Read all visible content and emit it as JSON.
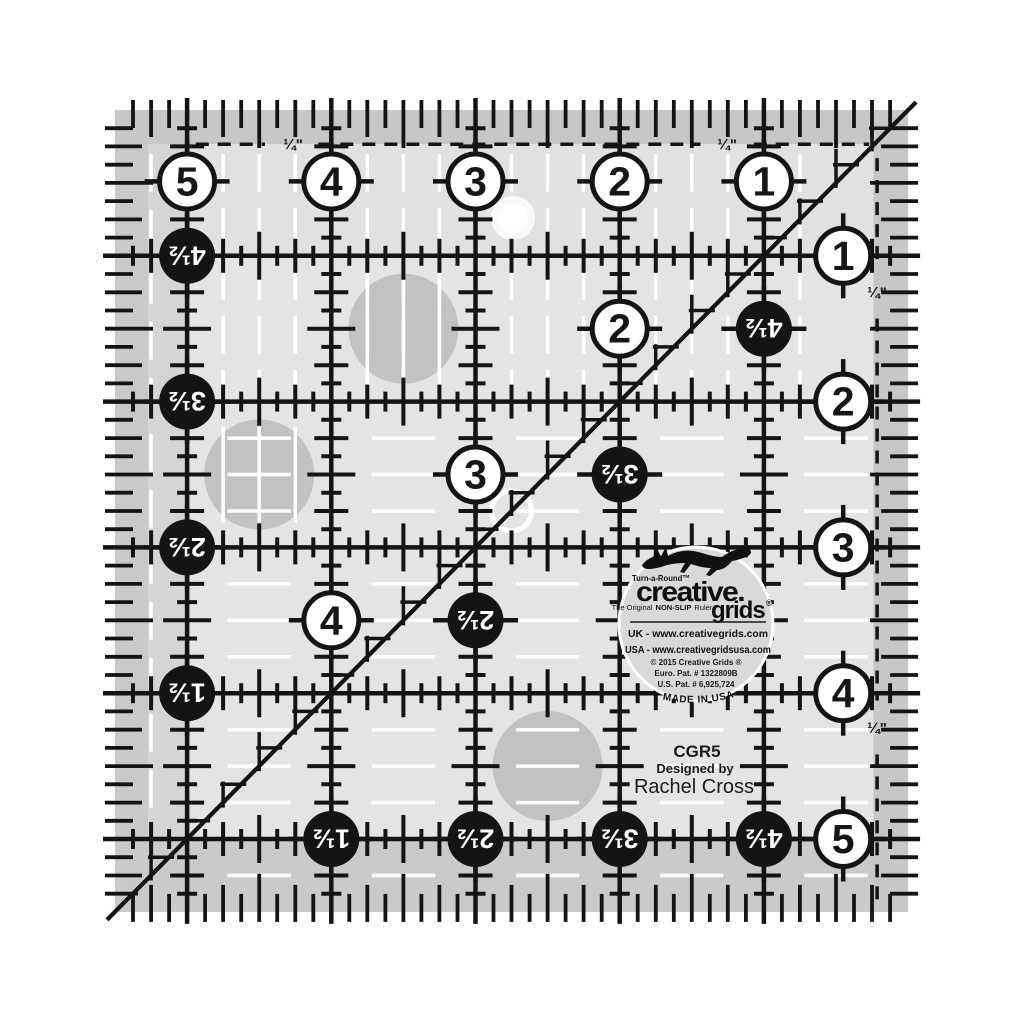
{
  "colors": {
    "background": "#ffffff",
    "ruler_base": "#e4e4e4",
    "band_dark": "#c7c7c7",
    "band_left_outer": "#c9c9c9",
    "band_bottom": "#cacaca",
    "band_left_inner": "#d5d5d5",
    "row1_band": "#e1e1e1",
    "ink": "#141414",
    "white": "#ffffff",
    "dot_gray": "#c2c2c2",
    "logo_bg": "#d9d9d9",
    "text_dark": "#1b1b1b"
  },
  "ruler": {
    "origin_x": 115,
    "origin_y": 110,
    "inch_x": 144.2,
    "inch_y": 145.8,
    "size_in": 5.5,
    "v_lines_in": [
      0.5,
      1.5,
      2.5,
      3.5,
      4.5
    ],
    "h_lines_in": [
      1,
      2,
      3,
      4,
      5
    ],
    "quarter_label": "¼\"",
    "quarter_positions": [
      {
        "x": 1.235,
        "y": 0.235
      },
      {
        "x": 4.245,
        "y": 0.235
      },
      {
        "x": 5.285,
        "y": 1.25
      },
      {
        "x": 5.285,
        "y": 4.24
      }
    ],
    "seam_h": {
      "y": 0.235,
      "segments": [
        [
          0.56,
          1.04
        ],
        [
          1.41,
          4.06
        ],
        [
          4.43,
          5.23
        ]
      ]
    },
    "seam_v": {
      "x": 5.285,
      "segments": [
        [
          0.33,
          1.07
        ],
        [
          1.43,
          4.05
        ],
        [
          4.42,
          5.44
        ]
      ]
    },
    "white_circles": [
      {
        "label": "5",
        "x": 0.5,
        "y": 0.49
      },
      {
        "label": "4",
        "x": 1.5,
        "y": 0.49
      },
      {
        "label": "3",
        "x": 2.5,
        "y": 0.49
      },
      {
        "label": "2",
        "x": 3.5,
        "y": 0.49
      },
      {
        "label": "1",
        "x": 4.5,
        "y": 0.49
      },
      {
        "label": "1",
        "x": 5.05,
        "y": 1
      },
      {
        "label": "2",
        "x": 5.05,
        "y": 2
      },
      {
        "label": "3",
        "x": 5.05,
        "y": 3
      },
      {
        "label": "4",
        "x": 5.05,
        "y": 4
      },
      {
        "label": "5",
        "x": 5.05,
        "y": 5
      },
      {
        "label": "2",
        "x": 3.5,
        "y": 1.5
      },
      {
        "label": "3",
        "x": 2.5,
        "y": 2.5
      },
      {
        "label": "4",
        "x": 1.5,
        "y": 3.5
      }
    ],
    "black_circles": [
      {
        "label": "4½",
        "x": 0.5,
        "y": 1
      },
      {
        "label": "3½",
        "x": 0.5,
        "y": 2
      },
      {
        "label": "2½",
        "x": 0.5,
        "y": 3
      },
      {
        "label": "1½",
        "x": 0.5,
        "y": 4
      },
      {
        "label": "4½",
        "x": 4.5,
        "y": 1.5
      },
      {
        "label": "3½",
        "x": 3.5,
        "y": 2.5
      },
      {
        "label": "2½",
        "x": 2.5,
        "y": 3.5
      },
      {
        "label": "1½",
        "x": 1.5,
        "y": 5
      },
      {
        "label": "2½",
        "x": 2.5,
        "y": 5
      },
      {
        "label": "3½",
        "x": 3.5,
        "y": 5
      },
      {
        "label": "4½",
        "x": 4.5,
        "y": 5
      }
    ],
    "gray_dots": [
      {
        "x": 2.0,
        "y": 1.5,
        "stripes": "v"
      },
      {
        "x": 1.0,
        "y": 2.5,
        "stripes": "v"
      },
      {
        "x": 3.0,
        "y": 4.5,
        "stripes": "h"
      }
    ],
    "center_ring": {
      "x": 2.75,
      "y": 2.75
    },
    "glare_dot": {
      "x": 2.76,
      "y": 0.74
    }
  },
  "logo": {
    "turnaround": "Turn-a-Round™",
    "brand_line1": "creative.",
    "brand_line2": "grids",
    "registered": "®",
    "tagline_prefix": "The Original",
    "tagline_bold": "NON-SLIP",
    "tagline_suffix": "Ruler",
    "uk_line": "UK - www.creativegrids.com",
    "usa_line": "USA - www.creativegridsusa.com",
    "copyright": "© 2015 Creative Grids ®",
    "euro_patent": "Euro. Pat. # 1322809B",
    "us_patent": "U.S. Pat. # 6,925,724",
    "made_in": "MADE IN USA"
  },
  "product": {
    "model": "CGR5",
    "designed_by": "Designed by",
    "designer": "Rachel Cross"
  }
}
